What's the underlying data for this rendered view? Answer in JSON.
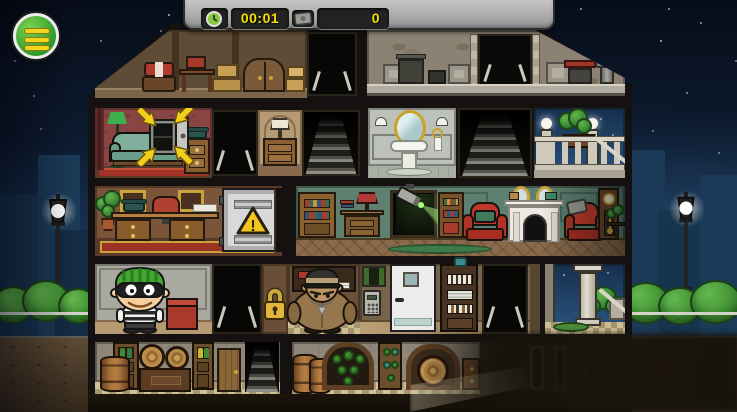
{
  "hud": {
    "timer_value": "00:01",
    "money_value": "0",
    "timer_icon": "clock-icon",
    "money_icon": "cash-icon",
    "text_color": "#f2e000",
    "bar_color": "#b9b9b9",
    "chip_color": "#232323"
  },
  "menu": {
    "icon": "hamburger-menu-icon",
    "button_color": "#3fa32e",
    "bars_color": "#f0d61d"
  },
  "objectives": {
    "safe_marker": {
      "icon": "target-arrows-icon",
      "arrow_count": 4,
      "arrow_color": "#f2cf1d"
    },
    "security_door_sign": {
      "icon": "warning-triangle-icon",
      "glyph": "!",
      "sign_color": "#f5c51d"
    },
    "locked_door": {
      "icon": "padlock-icon",
      "lock_color": "#e2b63a"
    },
    "keypad": {
      "icon": "keypad-icon"
    },
    "security_camera": {
      "icon": "security-camera-icon",
      "beam_color": "rgba(150,240,100,0.32)"
    }
  },
  "characters": {
    "player": {
      "id": "robber-character",
      "hat_color": "#43a832"
    },
    "guard": {
      "id": "guard-character",
      "uniform_color": "#96774e"
    }
  },
  "environment": {
    "sky_top": "#070d18",
    "sky_bottom": "#2e6292",
    "bush_color": "#3f8f33",
    "fog_color": "#1a140c"
  }
}
